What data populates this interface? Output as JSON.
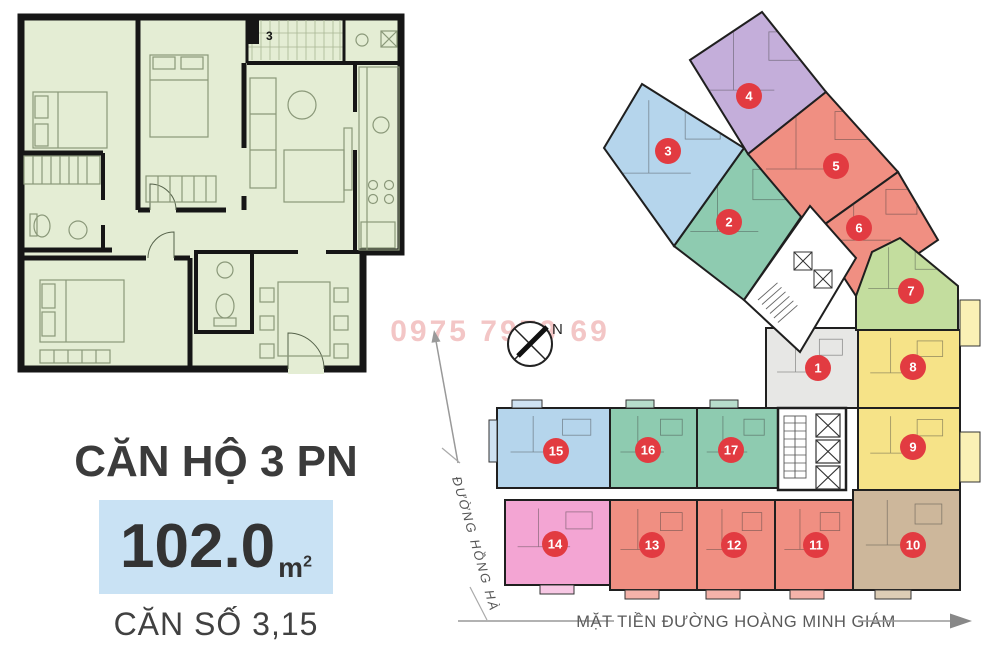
{
  "left_panel": {
    "plan_label": "3",
    "title": "CĂN HỘ 3 PN",
    "area_value": "102.0",
    "area_unit": "m",
    "area_sup": "2",
    "unit_numbers": "CĂN SỐ 3,15"
  },
  "site_plan": {
    "watermark": "0975 7979 69",
    "compass_label": "N",
    "street_side": "ĐƯỜNG HỒNG HÀ",
    "street_front": "MẶT TIỀN ĐƯỜNG HOÀNG MINH GIÁM",
    "marker_color": "#e23b41",
    "marker_text_color": "#ffffff",
    "units": [
      {
        "n": "1",
        "color": "#e7e7e5",
        "points": "766,328 858,328 858,408 766,408",
        "cx": 818,
        "cy": 368
      },
      {
        "n": "2",
        "color": "#8ecbb0",
        "points": "674,246 744,148 810,204 744,300",
        "cx": 729,
        "cy": 222
      },
      {
        "n": "3",
        "color": "#b5d5ec",
        "points": "642,84 744,148 674,246 604,148",
        "cx": 668,
        "cy": 151
      },
      {
        "n": "4",
        "color": "#c4aeda",
        "points": "690,60 762,12 826,92 748,154",
        "cx": 749,
        "cy": 96
      },
      {
        "n": "5",
        "color": "#f08f82",
        "points": "748,154 826,92 898,172 814,232",
        "cx": 836,
        "cy": 166
      },
      {
        "n": "6",
        "color": "#f08f82",
        "points": "814,232 898,172 938,240 856,296",
        "cx": 859,
        "cy": 228
      },
      {
        "n": "7",
        "color": "#c3dd9e",
        "points": "856,296 872,252 900,238 958,286 958,330 856,330",
        "cx": 911,
        "cy": 291
      },
      {
        "n": "8",
        "color": "#f6e388",
        "points": "858,330 960,330 960,408 858,408",
        "cx": 913,
        "cy": 367
      },
      {
        "n": "9",
        "color": "#f6e388",
        "points": "858,408 960,408 960,490 858,490",
        "cx": 913,
        "cy": 447
      },
      {
        "n": "10",
        "color": "#cdb79b",
        "points": "853,490 960,490 960,590 853,590",
        "cx": 913,
        "cy": 545
      },
      {
        "n": "11",
        "color": "#f08f82",
        "points": "775,500 853,500 853,590 775,590",
        "cx": 816,
        "cy": 545
      },
      {
        "n": "12",
        "color": "#f08f82",
        "points": "697,500 775,500 775,590 697,590",
        "cx": 734,
        "cy": 545
      },
      {
        "n": "13",
        "color": "#f08f82",
        "points": "610,500 697,500 697,590 610,590",
        "cx": 652,
        "cy": 545
      },
      {
        "n": "14",
        "color": "#f3a5d3",
        "points": "505,500 610,500 610,585 505,585",
        "cx": 555,
        "cy": 544
      },
      {
        "n": "15",
        "color": "#b5d5ec",
        "points": "497,408 610,408 610,488 497,488",
        "cx": 556,
        "cy": 451
      },
      {
        "n": "16",
        "color": "#8ecbb0",
        "points": "610,408 697,408 697,488 610,488",
        "cx": 648,
        "cy": 450
      },
      {
        "n": "17",
        "color": "#8ecbb0",
        "points": "697,408 778,408 778,488 697,488",
        "cx": 731,
        "cy": 450
      }
    ]
  }
}
